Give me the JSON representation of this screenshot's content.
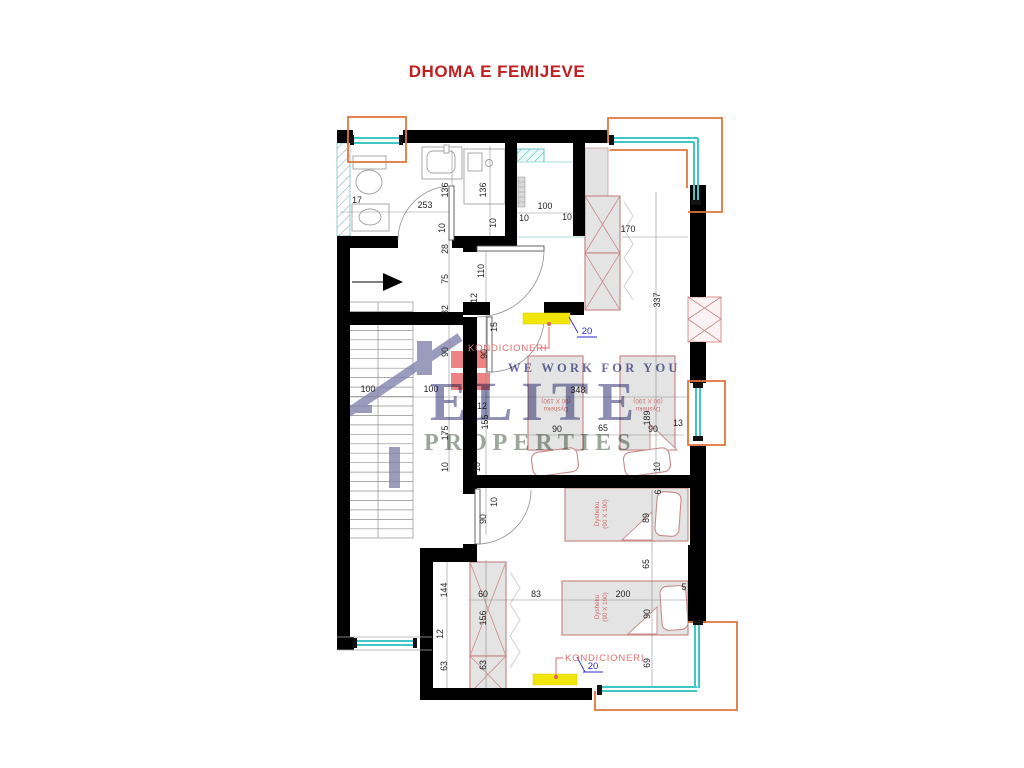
{
  "title": "DHOMA E FEMIJEVE",
  "watermark": {
    "tagline": "WE WORK FOR YOU",
    "brand_top": "ELITE",
    "brand_bottom": "PROPERTIES"
  },
  "labels": {
    "ac_top": "KONDICIONERI",
    "ac_top_value": "20",
    "ac_bottom": "KONDICIONERI",
    "ac_bottom_value": "20"
  },
  "colors": {
    "title_red": "#c02020",
    "wall_black": "#000000",
    "window_teal": "#3fc6c6",
    "frame_orange": "#e2763b",
    "ac_yellow": "#f2e50a",
    "furniture_stroke": "#c98a8a",
    "label_red": "#e57070",
    "value_blue": "#2b2bd0",
    "watermark_navy": "#4a4a8f"
  },
  "bed_labels": [
    {
      "x": 556,
      "y": 405,
      "r": 180,
      "name": "Dysheku",
      "size": "(90 X 190)"
    },
    {
      "x": 648,
      "y": 405,
      "r": 180,
      "name": "Dysheku",
      "size": "(90 X 190)"
    },
    {
      "x": 601,
      "y": 514,
      "r": -90,
      "name": "Dysheku",
      "size": "(90 X 190)"
    },
    {
      "x": 601,
      "y": 607,
      "r": -90,
      "name": "Dysheku",
      "size": "(90 X 190)"
    }
  ],
  "dimensions": [
    {
      "t": "17",
      "x": 357,
      "y": 203,
      "r": 0
    },
    {
      "t": "253",
      "x": 425,
      "y": 208,
      "r": 0
    },
    {
      "t": "136",
      "x": 448,
      "y": 190,
      "r": -90
    },
    {
      "t": "136",
      "x": 486,
      "y": 190,
      "r": -90
    },
    {
      "t": "100",
      "x": 545,
      "y": 209,
      "r": 0
    },
    {
      "t": "10",
      "x": 524,
      "y": 221,
      "r": 0
    },
    {
      "t": "10",
      "x": 567,
      "y": 220,
      "r": 0
    },
    {
      "t": "10",
      "x": 445,
      "y": 228,
      "r": -90
    },
    {
      "t": "10",
      "x": 496,
      "y": 223,
      "r": -90
    },
    {
      "t": "170",
      "x": 628,
      "y": 232,
      "r": 0
    },
    {
      "t": "337",
      "x": 660,
      "y": 300,
      "r": -90
    },
    {
      "t": "28",
      "x": 448,
      "y": 249,
      "r": -90
    },
    {
      "t": "75",
      "x": 448,
      "y": 279,
      "r": -90
    },
    {
      "t": "110",
      "x": 484,
      "y": 271,
      "r": -90
    },
    {
      "t": "12",
      "x": 477,
      "y": 298,
      "r": -90
    },
    {
      "t": "32",
      "x": 448,
      "y": 310,
      "r": -90
    },
    {
      "t": "15",
      "x": 497,
      "y": 327,
      "r": -90
    },
    {
      "t": "90",
      "x": 448,
      "y": 352,
      "r": -90
    },
    {
      "t": "90",
      "x": 487,
      "y": 354,
      "r": -90
    },
    {
      "t": "100",
      "x": 368,
      "y": 392,
      "r": 0
    },
    {
      "t": "100",
      "x": 431,
      "y": 392,
      "r": 0
    },
    {
      "t": "348",
      "x": 578,
      "y": 393,
      "r": 0
    },
    {
      "t": "12",
      "x": 482,
      "y": 409,
      "r": 0
    },
    {
      "t": "155",
      "x": 488,
      "y": 422,
      "r": -90
    },
    {
      "t": "175",
      "x": 448,
      "y": 433,
      "r": -90
    },
    {
      "t": "90",
      "x": 557,
      "y": 432,
      "r": 0
    },
    {
      "t": "65",
      "x": 603,
      "y": 431,
      "r": 0
    },
    {
      "t": "90",
      "x": 653,
      "y": 432,
      "r": 0
    },
    {
      "t": "13",
      "x": 678,
      "y": 426,
      "r": 0
    },
    {
      "t": "189",
      "x": 650,
      "y": 418,
      "r": -90
    },
    {
      "t": "10",
      "x": 448,
      "y": 467,
      "r": -90
    },
    {
      "t": "10",
      "x": 480,
      "y": 467,
      "r": -90
    },
    {
      "t": "10",
      "x": 660,
      "y": 467,
      "r": -90
    },
    {
      "t": "10",
      "x": 497,
      "y": 502,
      "r": -90
    },
    {
      "t": "90",
      "x": 486,
      "y": 519,
      "r": -90
    },
    {
      "t": "89",
      "x": 649,
      "y": 518,
      "r": -90
    },
    {
      "t": "6",
      "x": 661,
      "y": 492,
      "r": -90
    },
    {
      "t": "65",
      "x": 649,
      "y": 564,
      "r": -90
    },
    {
      "t": "144",
      "x": 447,
      "y": 590,
      "r": -90
    },
    {
      "t": "60",
      "x": 483,
      "y": 597,
      "r": 0
    },
    {
      "t": "83",
      "x": 536,
      "y": 597,
      "r": 0
    },
    {
      "t": "200",
      "x": 623,
      "y": 597,
      "r": 0
    },
    {
      "t": "5",
      "x": 684,
      "y": 590,
      "r": 0
    },
    {
      "t": "90",
      "x": 650,
      "y": 614,
      "r": -90
    },
    {
      "t": "156",
      "x": 486,
      "y": 618,
      "r": -90
    },
    {
      "t": "12",
      "x": 443,
      "y": 634,
      "r": -90
    },
    {
      "t": "63",
      "x": 447,
      "y": 666,
      "r": -90
    },
    {
      "t": "63",
      "x": 486,
      "y": 665,
      "r": -90
    },
    {
      "t": "69",
      "x": 650,
      "y": 663,
      "r": -90
    }
  ]
}
